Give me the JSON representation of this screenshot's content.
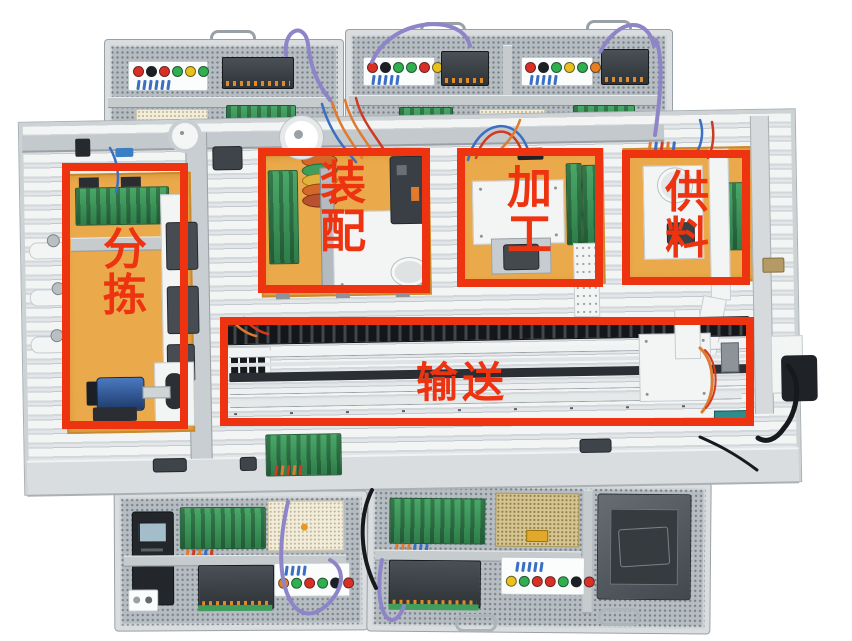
{
  "scene": {
    "type": "annotated equipment photograph",
    "subject": "Modular automated production line training system with five labelled work stations, upper and lower PLC control panels and an HMI touch screen",
    "background_color": "#ffffff"
  },
  "annotations": {
    "box_color": "#ee3311",
    "text_color": "#ee3311",
    "stations": {
      "sorting": {
        "label": "分拣",
        "orientation": "vertical"
      },
      "assembly": {
        "label": "装配",
        "orientation": "vertical"
      },
      "processing": {
        "label": "加工",
        "orientation": "vertical"
      },
      "supply": {
        "label": "供料",
        "orientation": "vertical"
      },
      "conveying": {
        "label": "输送",
        "orientation": "horizontal"
      }
    }
  },
  "palette": {
    "annotation_red": "#ee3311",
    "station_base_orange": "#eaa94a",
    "platform_gray": "#e0e4e6",
    "pcb_green": "#3f9e5c",
    "plc_dark": "#2e3337",
    "cable_purple": "#8e85c8",
    "psu_gold": "#d6c491"
  }
}
